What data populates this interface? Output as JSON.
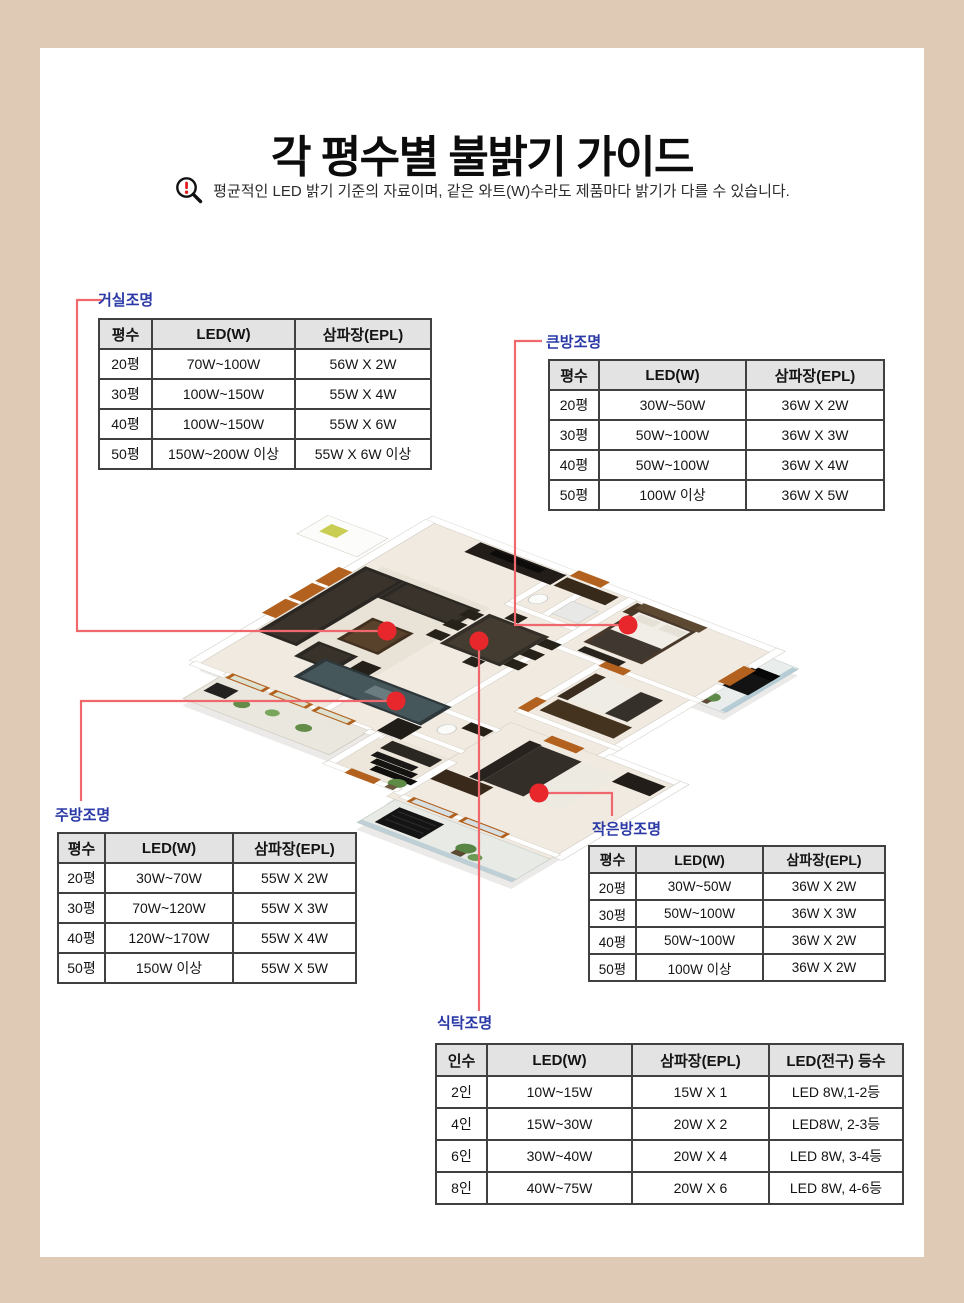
{
  "page": {
    "title": "각 평수별 불밝기 가이드",
    "notice": "평균적인 LED 밝기 기준의 자료이며, 같은 와트(W)수라도 제품마다 밝기가 다를 수 있습니다."
  },
  "colors": {
    "frame_tan": "#dfcab6",
    "label_blue": "#2a39a5",
    "connector_line": "#ef686d",
    "location_dot": "#e8272c",
    "table_header_bg": "#e3e3e3",
    "table_border": "#404040"
  },
  "tables": {
    "living": {
      "label": "거실조명",
      "headers": [
        "평수",
        "LED(W)",
        "삼파장(EPL)"
      ],
      "rows": [
        [
          "20평",
          "70W~100W",
          "56W X 2W"
        ],
        [
          "30평",
          "100W~150W",
          "55W X 4W"
        ],
        [
          "40평",
          "100W~150W",
          "55W X 6W"
        ],
        [
          "50평",
          "150W~200W 이상",
          "55W X 6W 이상"
        ]
      ]
    },
    "bigroom": {
      "label": "큰방조명",
      "headers": [
        "평수",
        "LED(W)",
        "삼파장(EPL)"
      ],
      "rows": [
        [
          "20평",
          "30W~50W",
          "36W X 2W"
        ],
        [
          "30평",
          "50W~100W",
          "36W X 3W"
        ],
        [
          "40평",
          "50W~100W",
          "36W X 4W"
        ],
        [
          "50평",
          "100W 이상",
          "36W X 5W"
        ]
      ]
    },
    "kitchen": {
      "label": "주방조명",
      "headers": [
        "평수",
        "LED(W)",
        "삼파장(EPL)"
      ],
      "rows": [
        [
          "20평",
          "30W~70W",
          "55W X 2W"
        ],
        [
          "30평",
          "70W~120W",
          "55W X 3W"
        ],
        [
          "40평",
          "120W~170W",
          "55W X 4W"
        ],
        [
          "50평",
          "150W 이상",
          "55W X 5W"
        ]
      ]
    },
    "smallroom": {
      "label": "작은방조명",
      "headers": [
        "평수",
        "LED(W)",
        "삼파장(EPL)"
      ],
      "rows": [
        [
          "20평",
          "30W~50W",
          "36W X 2W"
        ],
        [
          "30평",
          "50W~100W",
          "36W X 3W"
        ],
        [
          "40평",
          "50W~100W",
          "36W X 2W"
        ],
        [
          "50평",
          "100W 이상",
          "36W X 2W"
        ]
      ]
    },
    "dining": {
      "label": "식탁조명",
      "headers": [
        "인수",
        "LED(W)",
        "삼파장(EPL)",
        "LED(전구) 등수"
      ],
      "rows": [
        [
          "2인",
          "10W~15W",
          "15W X 1",
          "LED 8W,1-2등"
        ],
        [
          "4인",
          "15W~30W",
          "20W X 2",
          "LED8W, 2-3등"
        ],
        [
          "6인",
          "30W~40W",
          "20W X 4",
          "LED 8W, 3-4등"
        ],
        [
          "8인",
          "40W~75W",
          "20W X 6",
          "LED 8W, 4-6등"
        ]
      ]
    }
  }
}
